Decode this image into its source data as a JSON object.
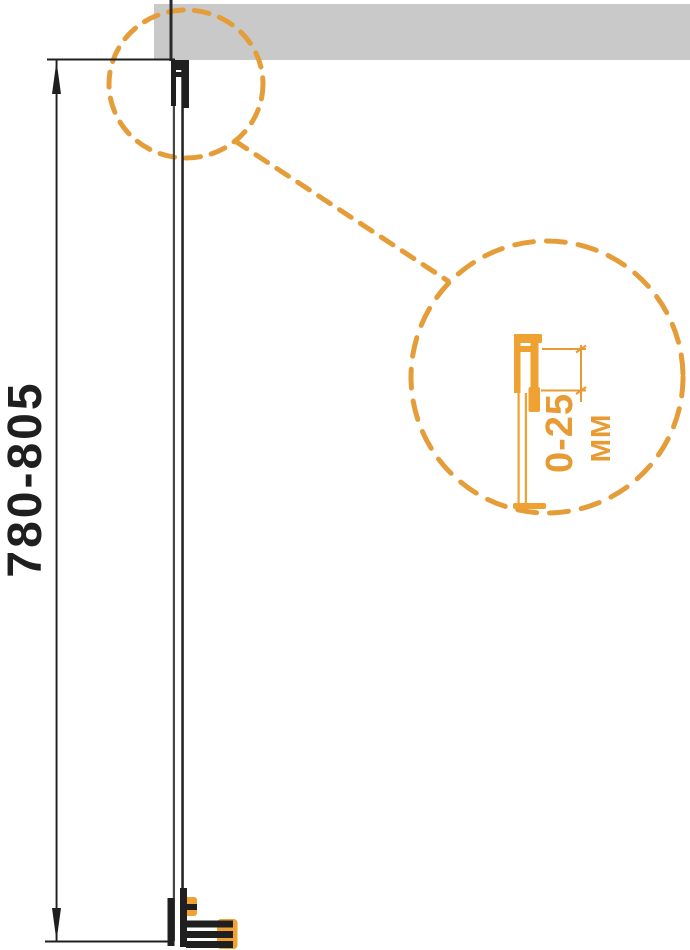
{
  "drawing": {
    "type": "installation-diagram",
    "dimension_label": "780-805",
    "detail": {
      "range_label": "0-25",
      "unit_label": "MM"
    },
    "colors": {
      "accent_orange": "#E89A33",
      "accent_orange_solid": "#EFA132",
      "wall_gray": "#C9C9C9",
      "ink_black": "#1F1F1F"
    }
  }
}
